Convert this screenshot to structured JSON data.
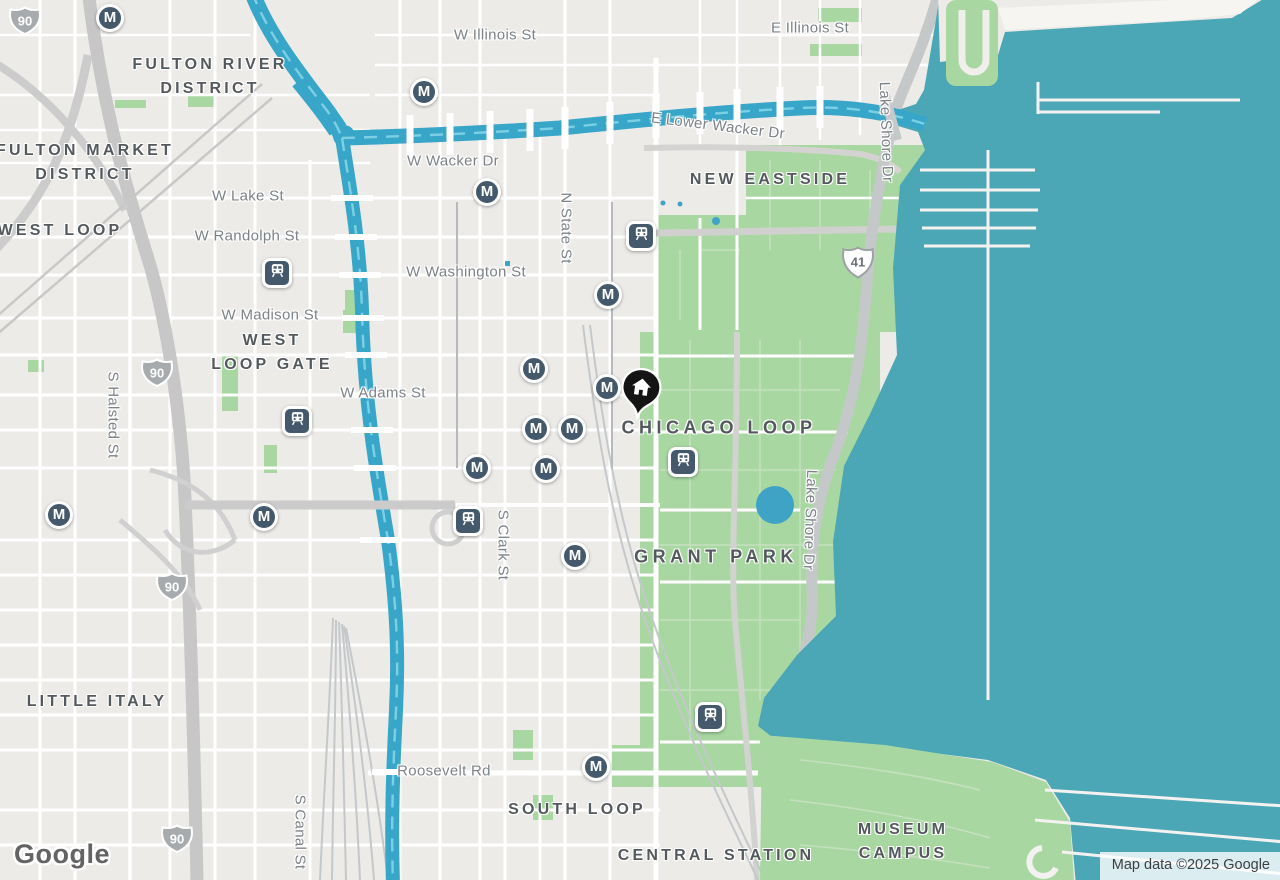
{
  "map_provider": {
    "logo_text": "Google",
    "attribution": "Map data ©2025 Google"
  },
  "colors": {
    "land": "#ecebe8",
    "water": "#4ba7b5",
    "river": "#38a6c8",
    "river_dash": "#7dd0e4",
    "park": "#a9d7a2",
    "road_major": "#c7c7c7",
    "road_minor": "#ffffff",
    "transit_marker": "#44596b",
    "home_pin": "#141414",
    "district_label": "#54595d",
    "street_label": "#7c8287",
    "interstate_shield": "#a7abad",
    "us_shield_text": "#6b7075"
  },
  "region_labels": [
    {
      "id": "fulton-river-district",
      "lines": "FULTON RIVER\nDISTRICT",
      "x": 210,
      "y": 77,
      "size": "md"
    },
    {
      "id": "fulton-market-district",
      "lines": "FULTON MARKET\nDISTRICT",
      "x": 85,
      "y": 163,
      "size": "md"
    },
    {
      "id": "west-loop",
      "lines": "WEST LOOP",
      "x": 60,
      "y": 231,
      "size": "md"
    },
    {
      "id": "west-loop-gate",
      "lines": "WEST\nLOOP GATE",
      "x": 272,
      "y": 353,
      "size": "md"
    },
    {
      "id": "little-italy",
      "lines": "LITTLE ITALY",
      "x": 97,
      "y": 702,
      "size": "md"
    },
    {
      "id": "new-eastside",
      "lines": "NEW EASTSIDE",
      "x": 770,
      "y": 180,
      "size": "md"
    },
    {
      "id": "chicago-loop",
      "lines": "CHICAGO LOOP",
      "x": 719,
      "y": 428,
      "size": "lg"
    },
    {
      "id": "grant-park",
      "lines": "GRANT PARK",
      "x": 716,
      "y": 557,
      "size": "lg"
    },
    {
      "id": "south-loop",
      "lines": "SOUTH LOOP",
      "x": 577,
      "y": 810,
      "size": "md"
    },
    {
      "id": "central-station",
      "lines": "CENTRAL STATION",
      "x": 716,
      "y": 856,
      "size": "md"
    },
    {
      "id": "museum-campus",
      "lines": "MUSEUM\nCAMPUS",
      "x": 903,
      "y": 842,
      "size": "md"
    }
  ],
  "street_labels": [
    {
      "id": "w-illinois-st",
      "text": "W Illinois St",
      "x": 495,
      "y": 35,
      "rotate": 0
    },
    {
      "id": "e-illinois-st",
      "text": "E Illinois St",
      "x": 810,
      "y": 28,
      "rotate": 0
    },
    {
      "id": "e-lower-wacker-dr",
      "text": "E Lower Wacker Dr",
      "x": 718,
      "y": 126,
      "rotate": 7
    },
    {
      "id": "w-wacker-dr",
      "text": "W Wacker Dr",
      "x": 453,
      "y": 161,
      "rotate": 0
    },
    {
      "id": "w-lake-st",
      "text": "W Lake St",
      "x": 248,
      "y": 196,
      "rotate": 0
    },
    {
      "id": "w-randolph-st",
      "text": "W Randolph St",
      "x": 247,
      "y": 236,
      "rotate": 0
    },
    {
      "id": "w-washington-st",
      "text": "W Washington St",
      "x": 466,
      "y": 272,
      "rotate": 0
    },
    {
      "id": "w-madison-st",
      "text": "W Madison St",
      "x": 270,
      "y": 315,
      "rotate": 0
    },
    {
      "id": "w-adams-st",
      "text": "W Adams St",
      "x": 383,
      "y": 393,
      "rotate": 0
    },
    {
      "id": "roosevelt-rd",
      "text": "Roosevelt Rd",
      "x": 444,
      "y": 771,
      "rotate": 0
    },
    {
      "id": "n-state-st",
      "text": "N State St",
      "x": 566,
      "y": 228,
      "rotate": 90
    },
    {
      "id": "s-halsted-st",
      "text": "S Halsted St",
      "x": 113,
      "y": 415,
      "rotate": 90
    },
    {
      "id": "s-clark-st",
      "text": "S Clark St",
      "x": 503,
      "y": 545,
      "rotate": 90
    },
    {
      "id": "s-canal-st",
      "text": "S Canal St",
      "x": 300,
      "y": 832,
      "rotate": 90
    },
    {
      "id": "lake-shore-dr-north",
      "text": "Lake Shore Dr",
      "x": 886,
      "y": 132,
      "rotate": 88
    },
    {
      "id": "lake-shore-dr-south",
      "text": "Lake Shore Dr",
      "x": 810,
      "y": 520,
      "rotate": 92
    }
  ],
  "route_shields": [
    {
      "system": "interstate",
      "number": "90",
      "x": 25,
      "y": 24
    },
    {
      "system": "interstate",
      "number": "90",
      "x": 157,
      "y": 376
    },
    {
      "system": "interstate",
      "number": "90",
      "x": 172,
      "y": 590
    },
    {
      "system": "interstate",
      "number": "90",
      "x": 177,
      "y": 842
    },
    {
      "system": "us-highway",
      "number": "41",
      "x": 858,
      "y": 265
    }
  ],
  "transit_markers": {
    "metro_glyph": "M",
    "stations": [
      {
        "type": "metro",
        "x": 110,
        "y": 18
      },
      {
        "type": "metro",
        "x": 424,
        "y": 92
      },
      {
        "type": "metro",
        "x": 487,
        "y": 192
      },
      {
        "type": "metro",
        "x": 608,
        "y": 295
      },
      {
        "type": "metro",
        "x": 534,
        "y": 369
      },
      {
        "type": "metro",
        "x": 607,
        "y": 388
      },
      {
        "type": "metro",
        "x": 536,
        "y": 429
      },
      {
        "type": "metro",
        "x": 572,
        "y": 429
      },
      {
        "type": "metro",
        "x": 477,
        "y": 468
      },
      {
        "type": "metro",
        "x": 546,
        "y": 469
      },
      {
        "type": "metro",
        "x": 59,
        "y": 515
      },
      {
        "type": "metro",
        "x": 264,
        "y": 517
      },
      {
        "type": "metro",
        "x": 575,
        "y": 556
      },
      {
        "type": "metro",
        "x": 596,
        "y": 767
      },
      {
        "type": "rail",
        "x": 277,
        "y": 273
      },
      {
        "type": "rail",
        "x": 641,
        "y": 236
      },
      {
        "type": "rail",
        "x": 297,
        "y": 421
      },
      {
        "type": "rail",
        "x": 468,
        "y": 521
      },
      {
        "type": "rail",
        "x": 683,
        "y": 462
      },
      {
        "type": "rail",
        "x": 710,
        "y": 717
      }
    ]
  },
  "saved_place": {
    "type": "home",
    "x": 640,
    "y": 400
  }
}
